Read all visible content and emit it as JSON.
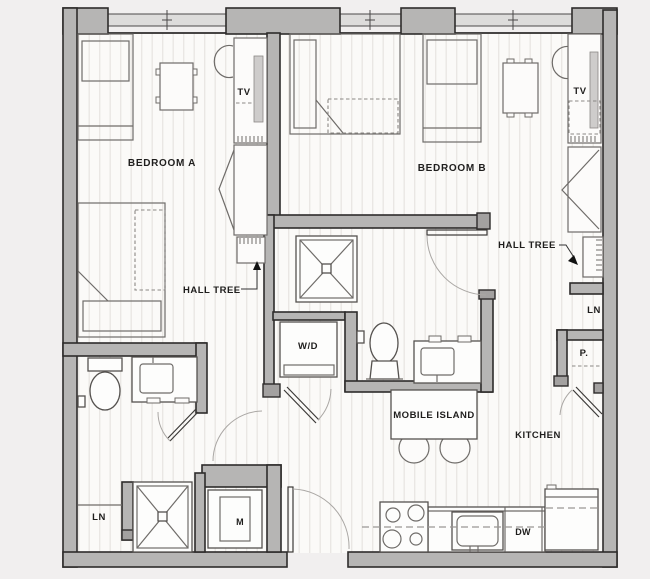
{
  "document": {
    "kind": "apartment floor plan",
    "bedrooms_shown": 2
  },
  "labels": {
    "bedroom_a": "BEDROOM A",
    "bedroom_b": "BEDROOM B",
    "tv_a": "TV",
    "tv_b": "TV",
    "hall_tree_a": "HALL TREE",
    "hall_tree_b": "HALL TREE",
    "wd": "W/D",
    "mobile_island": "MOBILE ISLAND",
    "kitchen": "KITCHEN",
    "ln_left": "LN",
    "ln_right": "LN",
    "pantry": "P.",
    "mech": "M",
    "dw": "DW"
  },
  "colors": {
    "background": "#f1efef",
    "wall_fill": "#b6b5b4",
    "wall_stroke": "#2e2c2b",
    "floor": "#fbfaf8",
    "floor_stripe": "#e9e6e3",
    "furniture_line": "#6f6c69",
    "label_text": "#1f1e1d"
  }
}
